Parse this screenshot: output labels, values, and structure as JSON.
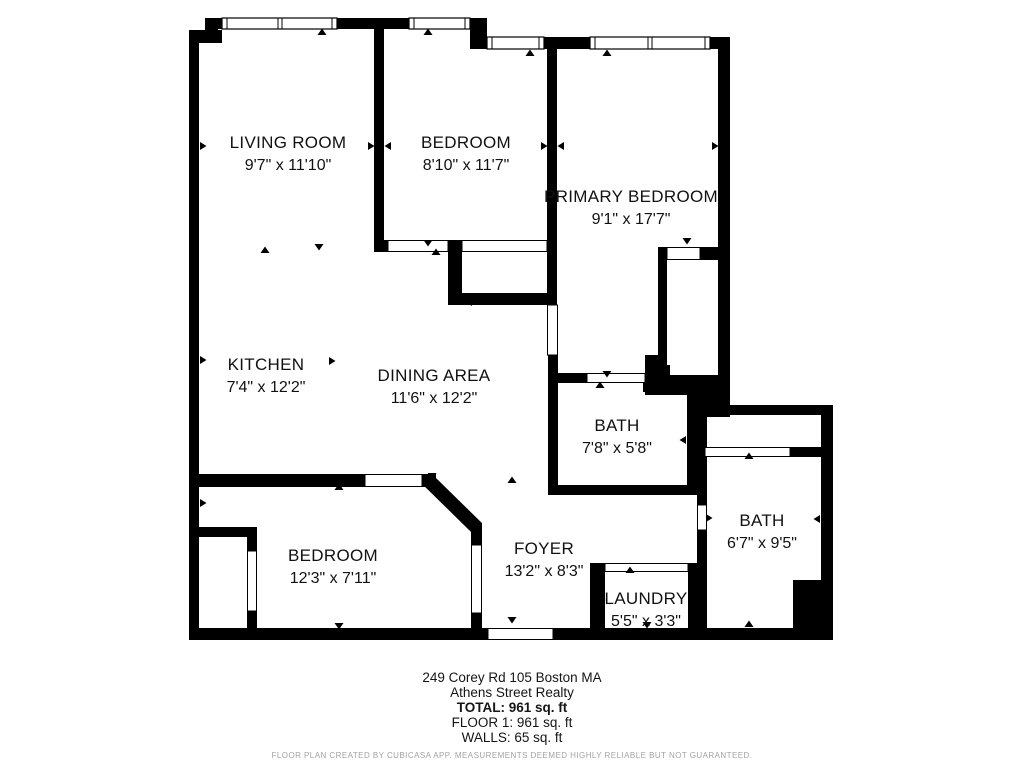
{
  "plan": {
    "rooms": [
      {
        "name": "LIVING ROOM",
        "dims": "9'7\" x 11'10\""
      },
      {
        "name": "BEDROOM",
        "dims": "8'10\" x 11'7\""
      },
      {
        "name": "PRIMARY BEDROOM",
        "dims": "9'1\" x 17'7\""
      },
      {
        "name": "KITCHEN",
        "dims": "7'4\" x 12'2\""
      },
      {
        "name": "DINING AREA",
        "dims": "11'6\" x 12'2\""
      },
      {
        "name": "BATH",
        "dims": "7'8\" x 5'8\""
      },
      {
        "name": "BATH",
        "dims": "6'7\" x 9'5\""
      },
      {
        "name": "BEDROOM",
        "dims": "12'3\" x 7'11\""
      },
      {
        "name": "FOYER",
        "dims": "13'2\" x 8'3\""
      },
      {
        "name": "LAUNDRY",
        "dims": "5'5\" x 3'3\""
      }
    ]
  },
  "footer": {
    "address": "249 Corey Rd 105 Boston MA",
    "company": "Athens Street Realty",
    "total": "TOTAL: 961 sq. ft",
    "floor": "FLOOR 1: 961 sq. ft",
    "walls": "WALLS: 65 sq. ft",
    "disclaimer": "FLOOR PLAN CREATED BY CUBICASA APP. MEASUREMENTS DEEMED HIGHLY RELIABLE BUT NOT GUARANTEED."
  },
  "colors": {
    "wall": "#000000",
    "text": "#111111",
    "muted": "#a3a3a3",
    "background": "#ffffff"
  }
}
